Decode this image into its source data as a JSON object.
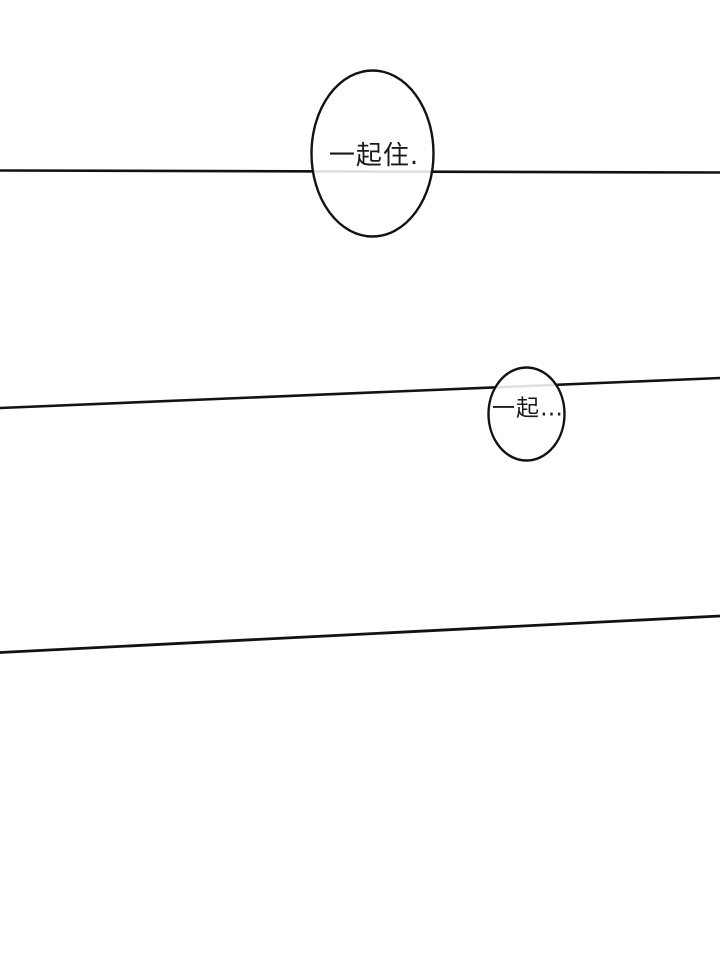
{
  "page": {
    "kind": "comic-page",
    "background_color": "#ffffff",
    "panel_line_color": "#121212",
    "faint_line_through_bubble_color": "#d9d9d9",
    "text_color": "#1a1a1a"
  },
  "bubbles": [
    {
      "id": "speech-bubble-1",
      "text": "一起住."
    },
    {
      "id": "speech-bubble-2",
      "text": "一起…"
    }
  ]
}
